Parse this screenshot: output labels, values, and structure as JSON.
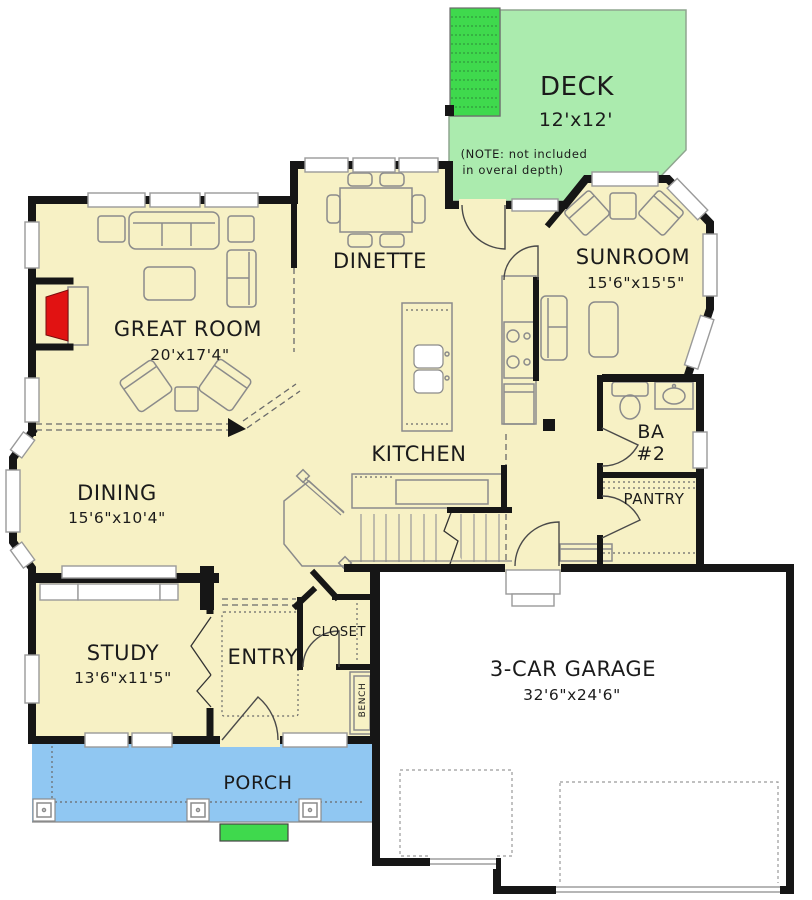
{
  "colors": {
    "background": "#ffffff",
    "floor": "#f7f1c5",
    "deck": "#abebae",
    "bright_green": "#3fd94d",
    "porch": "#90c7f2",
    "garage_floor": "#ffffff",
    "fireplace_red": "#e11212",
    "wall": "#161616",
    "furniture_line": "#8b8b8b",
    "window_line": "#9a9a9a"
  },
  "rooms": {
    "deck": {
      "name": "DECK",
      "dims": "12'x12'",
      "note_line1": "(NOTE: not included",
      "note_line2": "in overal depth)"
    },
    "dinette": {
      "name": "DINETTE"
    },
    "sunroom": {
      "name": "SUNROOM",
      "dims": "15'6\"x15'5\""
    },
    "great_room": {
      "name": "GREAT ROOM",
      "dims": "20'x17'4\""
    },
    "kitchen": {
      "name": "KITCHEN"
    },
    "dining": {
      "name": "DINING",
      "dims": "15'6\"x10'4\""
    },
    "bath2": {
      "name_line1": "BA",
      "name_line2": "#2"
    },
    "pantry": {
      "name": "PANTRY"
    },
    "study": {
      "name": "STUDY",
      "dims": "13'6\"x11'5\""
    },
    "entry": {
      "name": "ENTRY"
    },
    "closet": {
      "name": "CLOSET"
    },
    "bench": {
      "name": "BENCH"
    },
    "garage": {
      "name": "3-CAR GARAGE",
      "dims": "32'6\"x24'6\""
    },
    "porch": {
      "name": "PORCH"
    }
  }
}
